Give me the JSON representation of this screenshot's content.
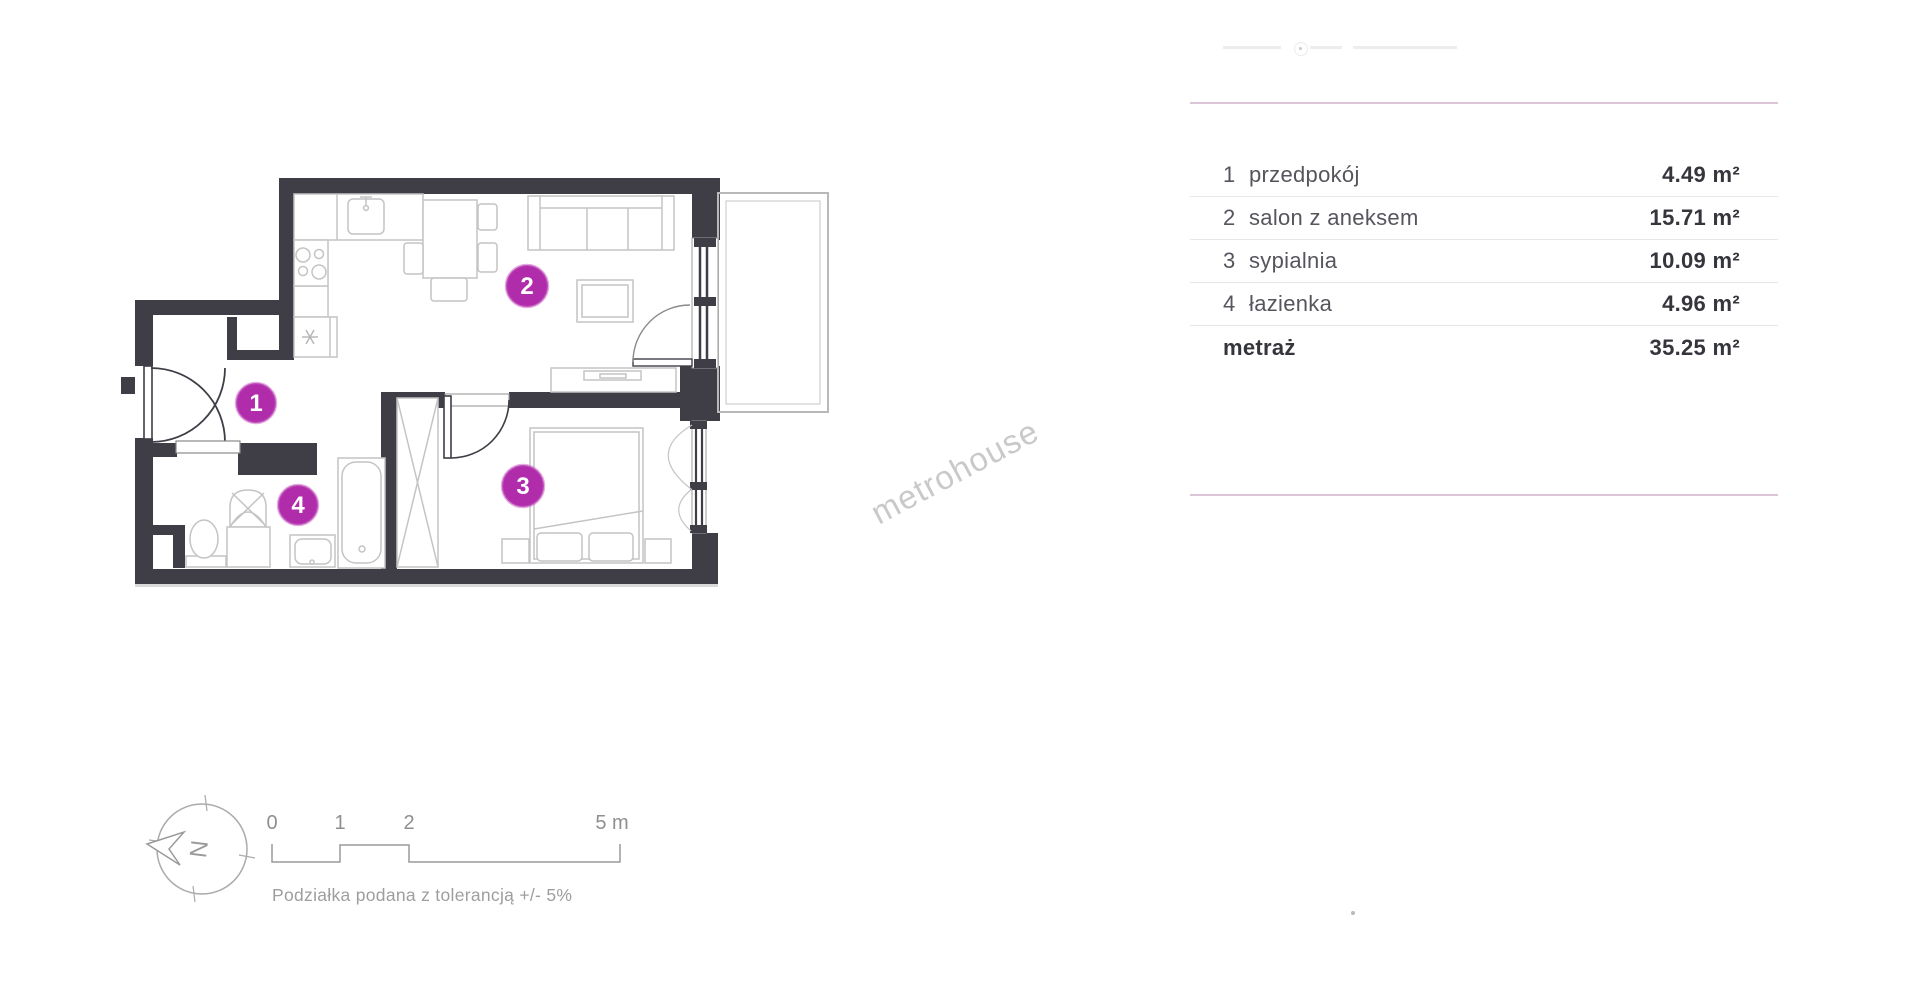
{
  "rooms": [
    {
      "number": "1",
      "name": "przedpokój",
      "area": "4.49 m²"
    },
    {
      "number": "2",
      "name": "salon z aneksem",
      "area": "15.71 m²"
    },
    {
      "number": "3",
      "name": "sypialnia",
      "area": "10.09 m²"
    },
    {
      "number": "4",
      "name": "łazienka",
      "area": "4.96 m²"
    }
  ],
  "total": {
    "label": "metraż",
    "area": "35.25 m²"
  },
  "watermark": {
    "text": "metrohouse"
  },
  "compass": {
    "letter": "N"
  },
  "scale_bar": {
    "labels": [
      "0",
      "1",
      "2",
      "5 m"
    ],
    "caption": "Podziałka podana z tolerancją +/- 5%"
  },
  "colors": {
    "wall": "#3f3e47",
    "badge": "#b02cab",
    "badge_ring": "#ca67c5",
    "divider_pink": "#ddc6d8",
    "row_line": "#e7e7e7",
    "furniture_line": "#c4c4c4",
    "text_dark": "#35353c",
    "text_medium": "#55555d",
    "muted": "#9a9a9a",
    "watermark_gray": "#c9c9c9"
  }
}
